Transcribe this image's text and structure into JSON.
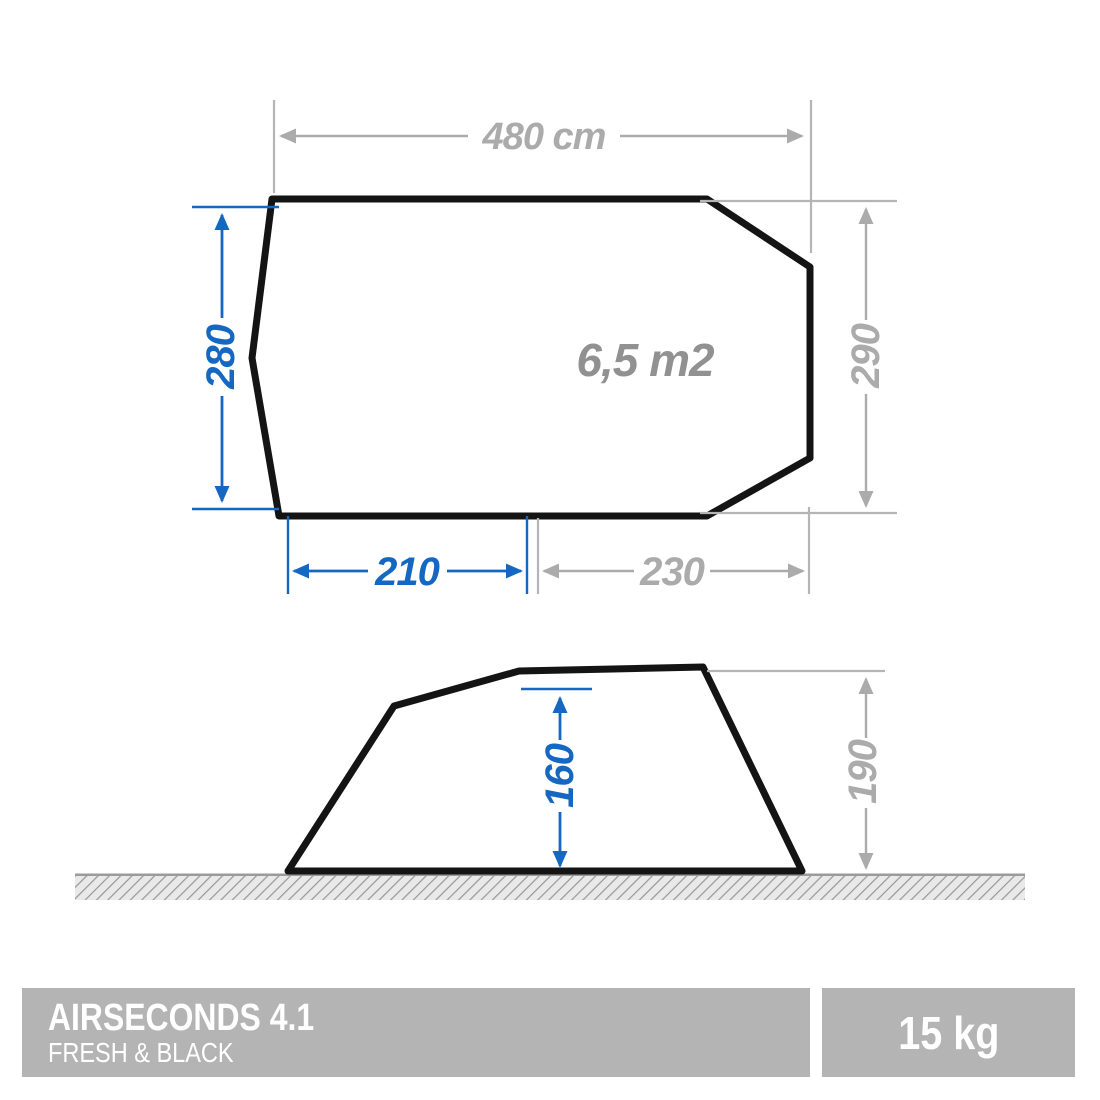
{
  "top_view": {
    "width_label": "480 cm",
    "bedroom_depth_label": "280",
    "tent_depth_label": "290",
    "bedroom_width_label": "210",
    "living_width_label": "230",
    "living_area_label": "6,5 m2",
    "sleeping_spots": 4
  },
  "side_view": {
    "inner_height_label": "160",
    "outer_height_label": "190"
  },
  "footer": {
    "product_name": "AIRSECONDS 4.1",
    "product_subtitle": "FRESH & BLACK",
    "weight": "15 kg"
  },
  "colors": {
    "accent_blue": "#1567c2",
    "dimension_gray": "#ababab",
    "bedroom_fill": "#a7c2e3",
    "mat_fill": "#dfe4f4",
    "outline_black": "#141414",
    "footer_bar_gray": "#b4b4b4"
  }
}
